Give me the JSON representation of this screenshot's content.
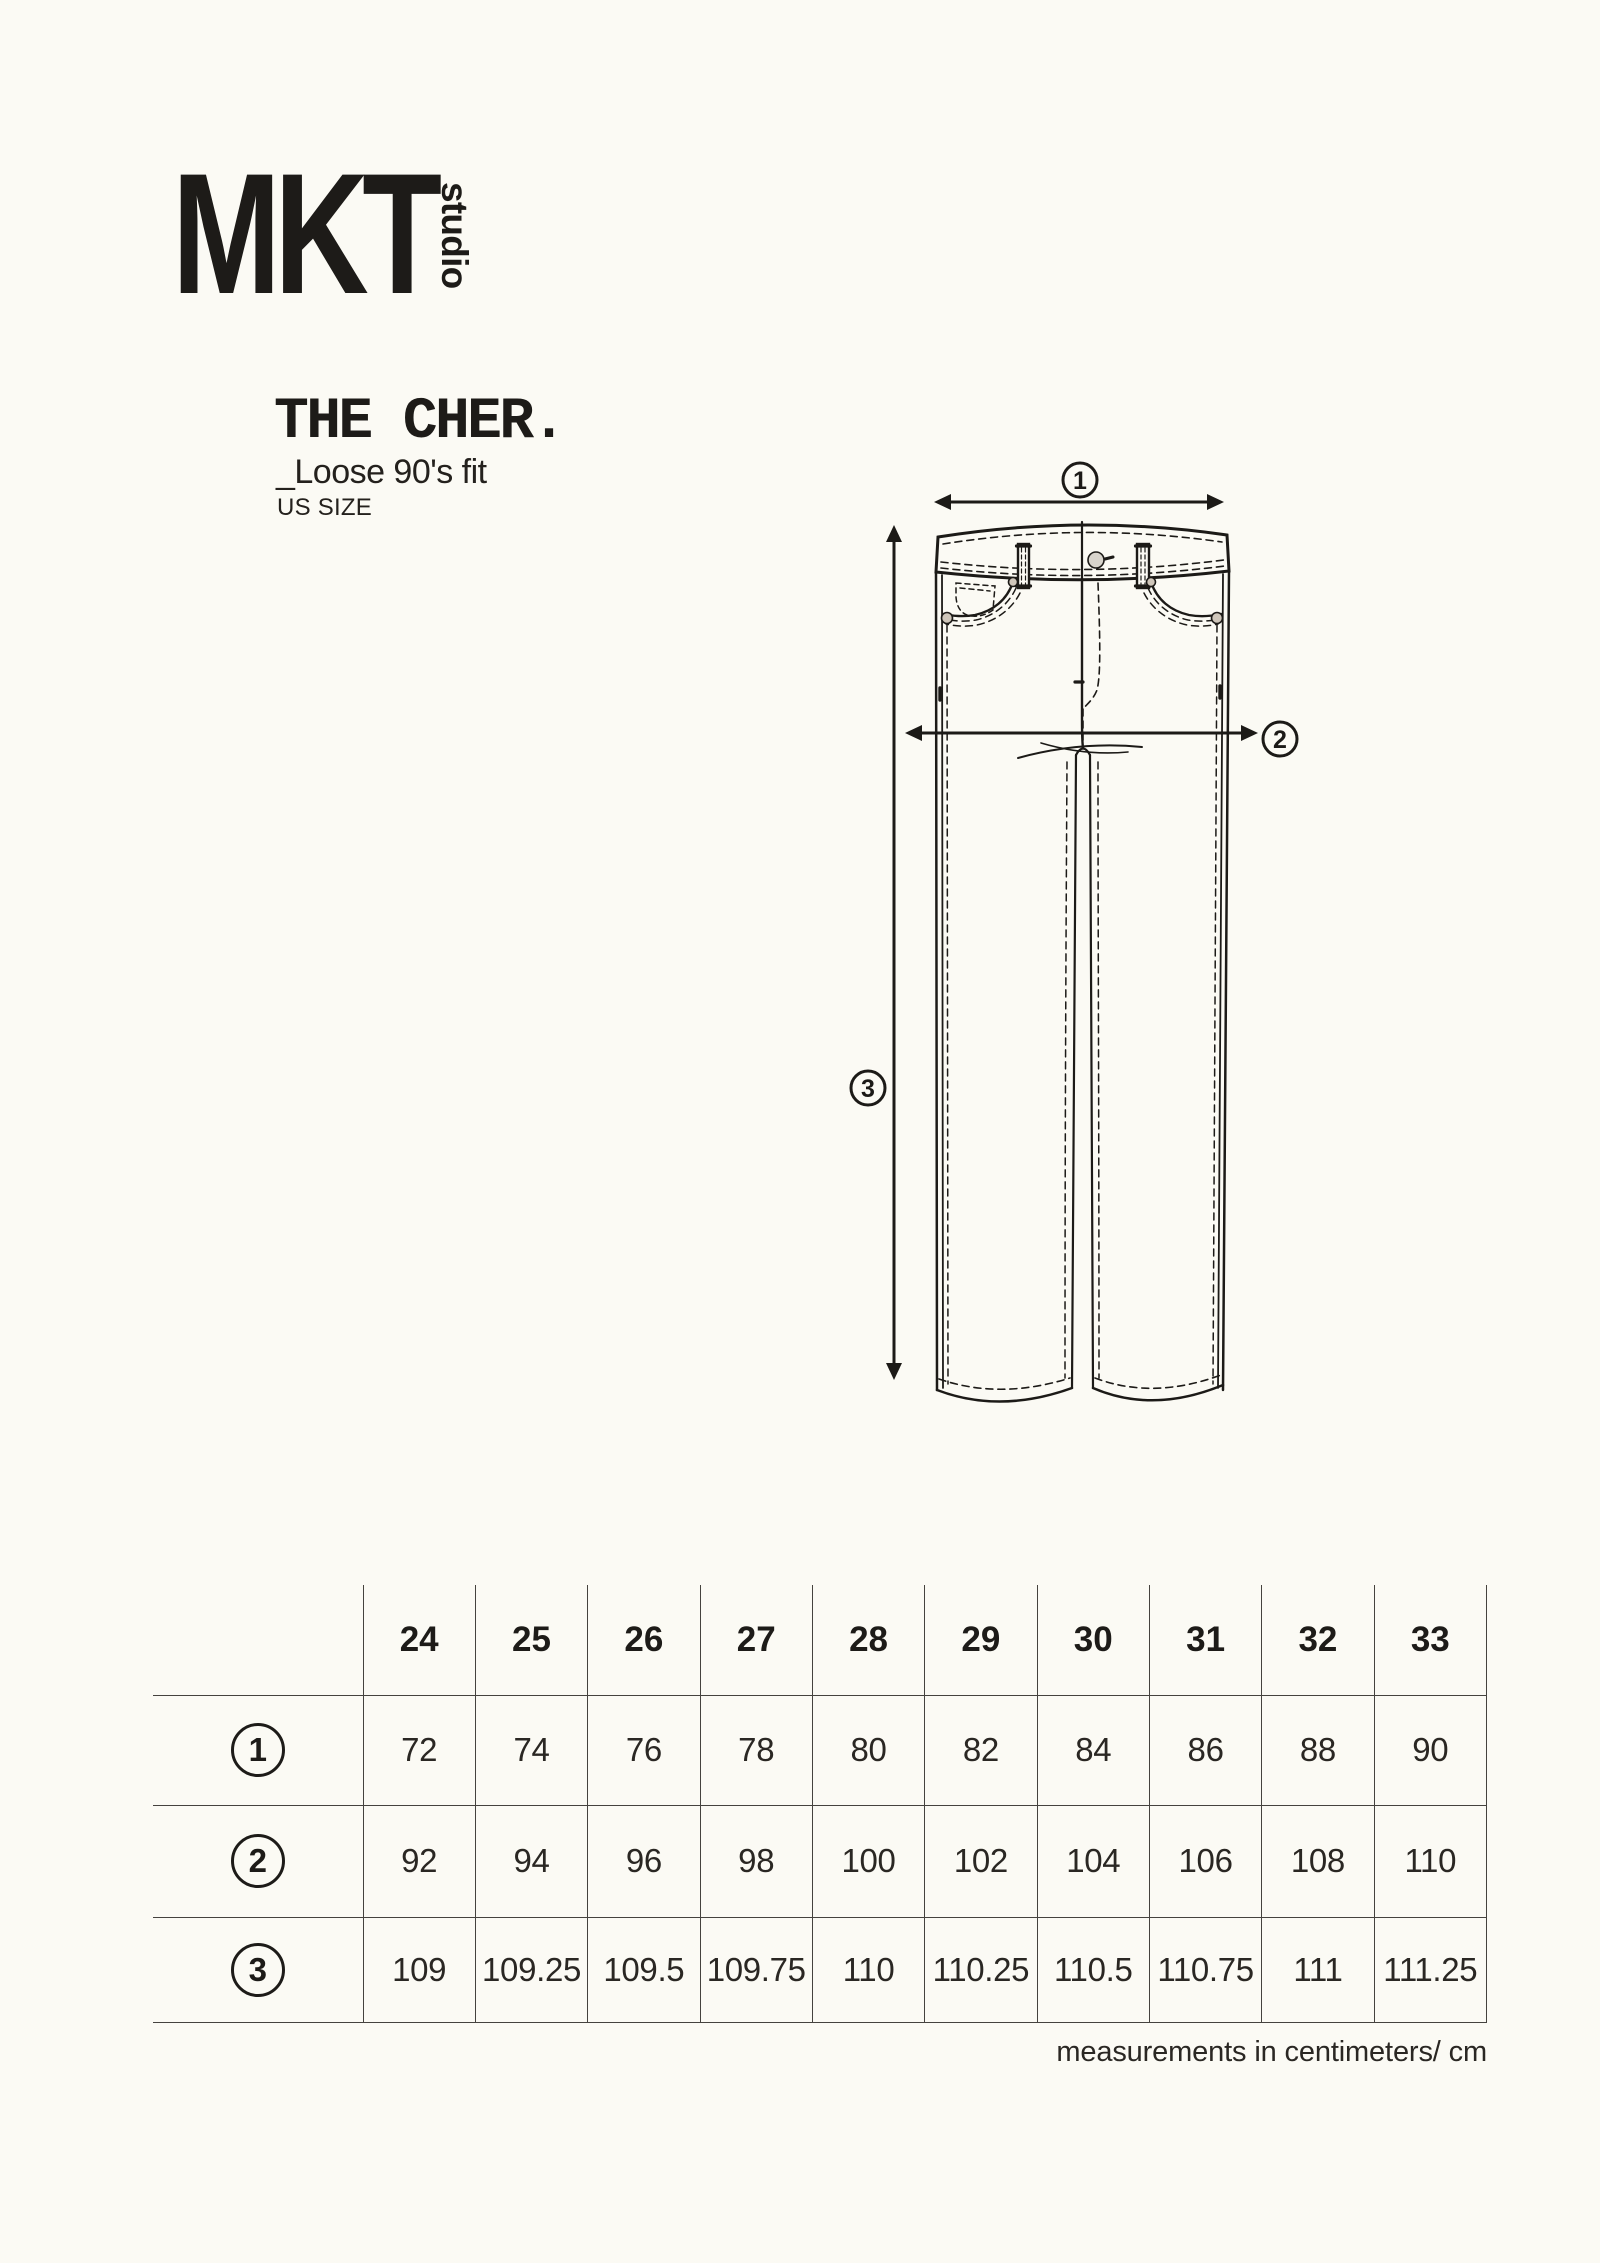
{
  "logo": {
    "brand": "MKT",
    "studio": "studio"
  },
  "product": {
    "name": "THE CHER.",
    "fit": "_Loose 90's fit",
    "size_standard": "US SIZE"
  },
  "diagram": {
    "labels": [
      "1",
      "2",
      "3"
    ]
  },
  "table": {
    "sizes": [
      "24",
      "25",
      "26",
      "27",
      "28",
      "29",
      "30",
      "31",
      "32",
      "33"
    ],
    "rows": [
      {
        "label": "1",
        "values": [
          "72",
          "74",
          "76",
          "78",
          "80",
          "82",
          "84",
          "86",
          "88",
          "90"
        ]
      },
      {
        "label": "2",
        "values": [
          "92",
          "94",
          "96",
          "98",
          "100",
          "102",
          "104",
          "106",
          "108",
          "110"
        ]
      },
      {
        "label": "3",
        "values": [
          "109",
          "109.25",
          "109.5",
          "109.75",
          "110",
          "110.25",
          "110.5",
          "110.75",
          "111",
          "111.25"
        ]
      }
    ]
  },
  "caption": "measurements in centimeters/ cm",
  "colors": {
    "background": "#FBFAF4",
    "ink": "#1D1B18",
    "grid": "#45423E"
  }
}
